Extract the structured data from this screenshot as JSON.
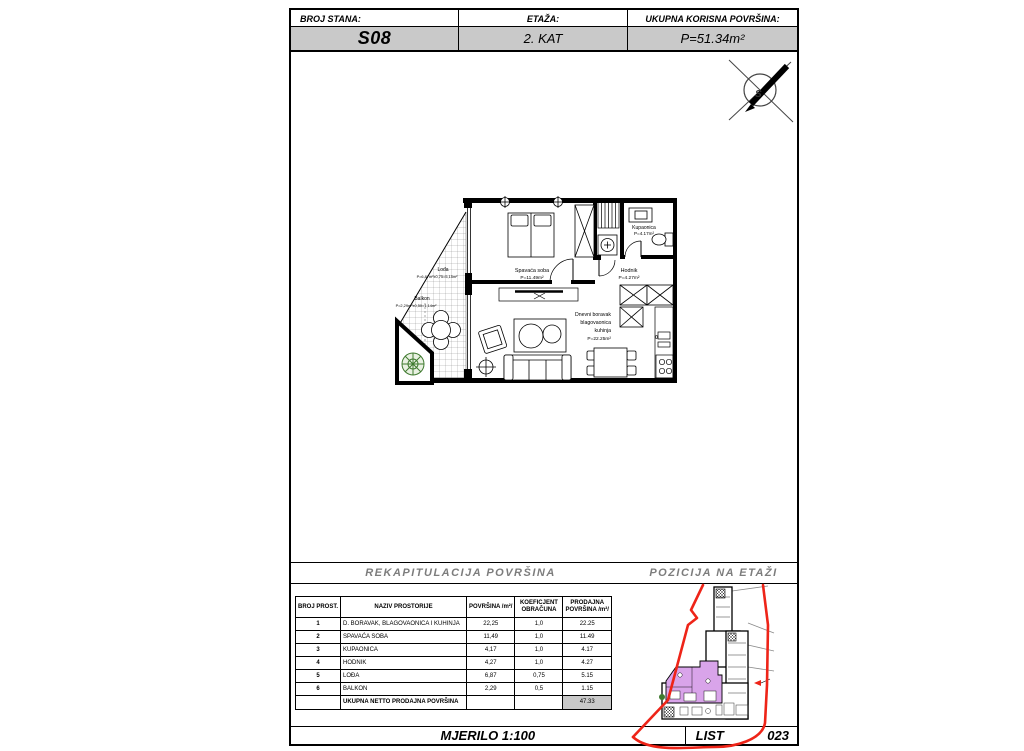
{
  "header": {
    "broj_stana_label": "BROJ STANA:",
    "broj_stana_value": "S08",
    "etaza_label": "ETAŽA:",
    "etaza_value": "2. KAT",
    "ukupna_label": "UKUPNA KORISNA POVRŠINA:",
    "ukupna_value": "P=51.34m²"
  },
  "plan": {
    "spavaca_name": "Spavaća soba",
    "spavaca_area": "P=11.49m²",
    "kupaonica_name": "Kupaonica",
    "kupaonica_area": "P=4.17m²",
    "hodnik_name": "Hodnik",
    "hodnik_area": "P=4.27m²",
    "dnevni_line1": "Dnevni boravak",
    "dnevni_line2": "blagovaonica",
    "dnevni_line3": "kuhinja",
    "dnevni_area": "P=22.25m²",
    "loda_name": "Lođa",
    "loda_area": "P=6,87m²x0,75=5,15m²",
    "balkon_name": "Balkon",
    "balkon_area": "P=2,29m²x0,50=1,14m²",
    "north_letter": "S"
  },
  "sections": {
    "rekapitulacija": "REKAPITULACIJA POVRŠINA",
    "pozicija": "POZICIJA NA ETAŽI"
  },
  "table": {
    "headers": {
      "broj": "BROJ PROST.",
      "naziv": "NAZIV PROSTORIJE",
      "povrsina": "POVRŠINA /m²/",
      "koef_line1": "KOEFICJENT",
      "koef_line2": "OBRAČUNA",
      "prod_line1": "PRODAJNA",
      "prod_line2": "POVRŠINA /m²/"
    },
    "rows": [
      {
        "num": "1",
        "naziv": "D. BORAVAK, BLAGOVAONICA I KUHINJA",
        "povrsina": "22,25",
        "koef": "1,0",
        "prodajna": "22.25"
      },
      {
        "num": "2",
        "naziv": "SPAVAĆA SOBA",
        "povrsina": "11,49",
        "koef": "1,0",
        "prodajna": "11.49"
      },
      {
        "num": "3",
        "naziv": "KUPAONICA",
        "povrsina": "4,17",
        "koef": "1,0",
        "prodajna": "4.17"
      },
      {
        "num": "4",
        "naziv": "HODNIK",
        "povrsina": "4,27",
        "koef": "1,0",
        "prodajna": "4.27"
      },
      {
        "num": "5",
        "naziv": "LOĐA",
        "povrsina": "6,87",
        "koef": "0,75",
        "prodajna": "5.15"
      },
      {
        "num": "6",
        "naziv": "BALKON",
        "povrsina": "2,29",
        "koef": "0,5",
        "prodajna": "1.15"
      }
    ],
    "total_label": "UKUPNA NETTO PRODAJNA POVRŠINA",
    "total_value": "47.33"
  },
  "footer": {
    "mjerilo": "MJERILO  1:100",
    "list_label": "LIST",
    "list_value": "023"
  },
  "colors": {
    "boundary_red": "#ee2418",
    "apartment_purple": "#d9a4ea",
    "plant_green": "#3f7a2f",
    "gray_fill": "#c9c9c9",
    "gray_text": "#7d7d7d"
  }
}
